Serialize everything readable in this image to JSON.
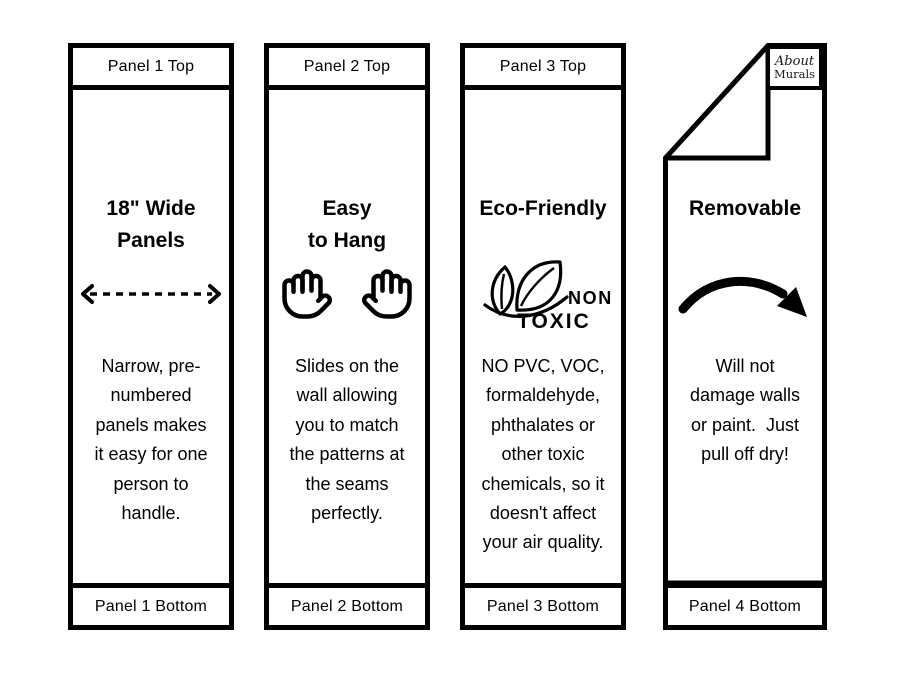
{
  "colors": {
    "ink": "#000000",
    "paper": "#ffffff"
  },
  "panels": [
    {
      "top_label": "Panel 1 Top",
      "title_lines": [
        "18\" Wide",
        "Panels"
      ],
      "icon": "width-double-arrow-dashed",
      "body_lines": [
        "Narrow, pre-",
        "numbered",
        "panels makes",
        "it easy for one",
        "person to",
        "handle."
      ],
      "bottom_label": "Panel 1 Bottom"
    },
    {
      "top_label": "Panel 2 Top",
      "title_lines": [
        "Easy",
        "to Hang"
      ],
      "icon": "raised-hands",
      "body_lines": [
        "Slides on the",
        "wall allowing",
        "you to match",
        "the patterns at",
        "the seams",
        "perfectly."
      ],
      "bottom_label": "Panel 2 Bottom"
    },
    {
      "top_label": "Panel 3 Top",
      "title_lines": [
        "Eco-Friendly"
      ],
      "icon": "non-toxic-leaves",
      "icon_text": {
        "word1": "NON",
        "word2": "TOXIC"
      },
      "body_lines": [
        "NO PVC, VOC,",
        "formaldehyde,",
        "phthalates or",
        "other toxic",
        "chemicals, so it",
        "doesn't affect",
        "your air quality."
      ],
      "bottom_label": "Panel 3 Bottom"
    },
    {
      "logo": {
        "line1": "About",
        "line2": "Murals"
      },
      "title_lines": [
        "Removable"
      ],
      "icon": "curved-arrow",
      "body_lines": [
        "Will not",
        "damage walls",
        "or paint.  Just",
        "pull off dry!"
      ],
      "bottom_label": "Panel 4 Bottom"
    }
  ]
}
